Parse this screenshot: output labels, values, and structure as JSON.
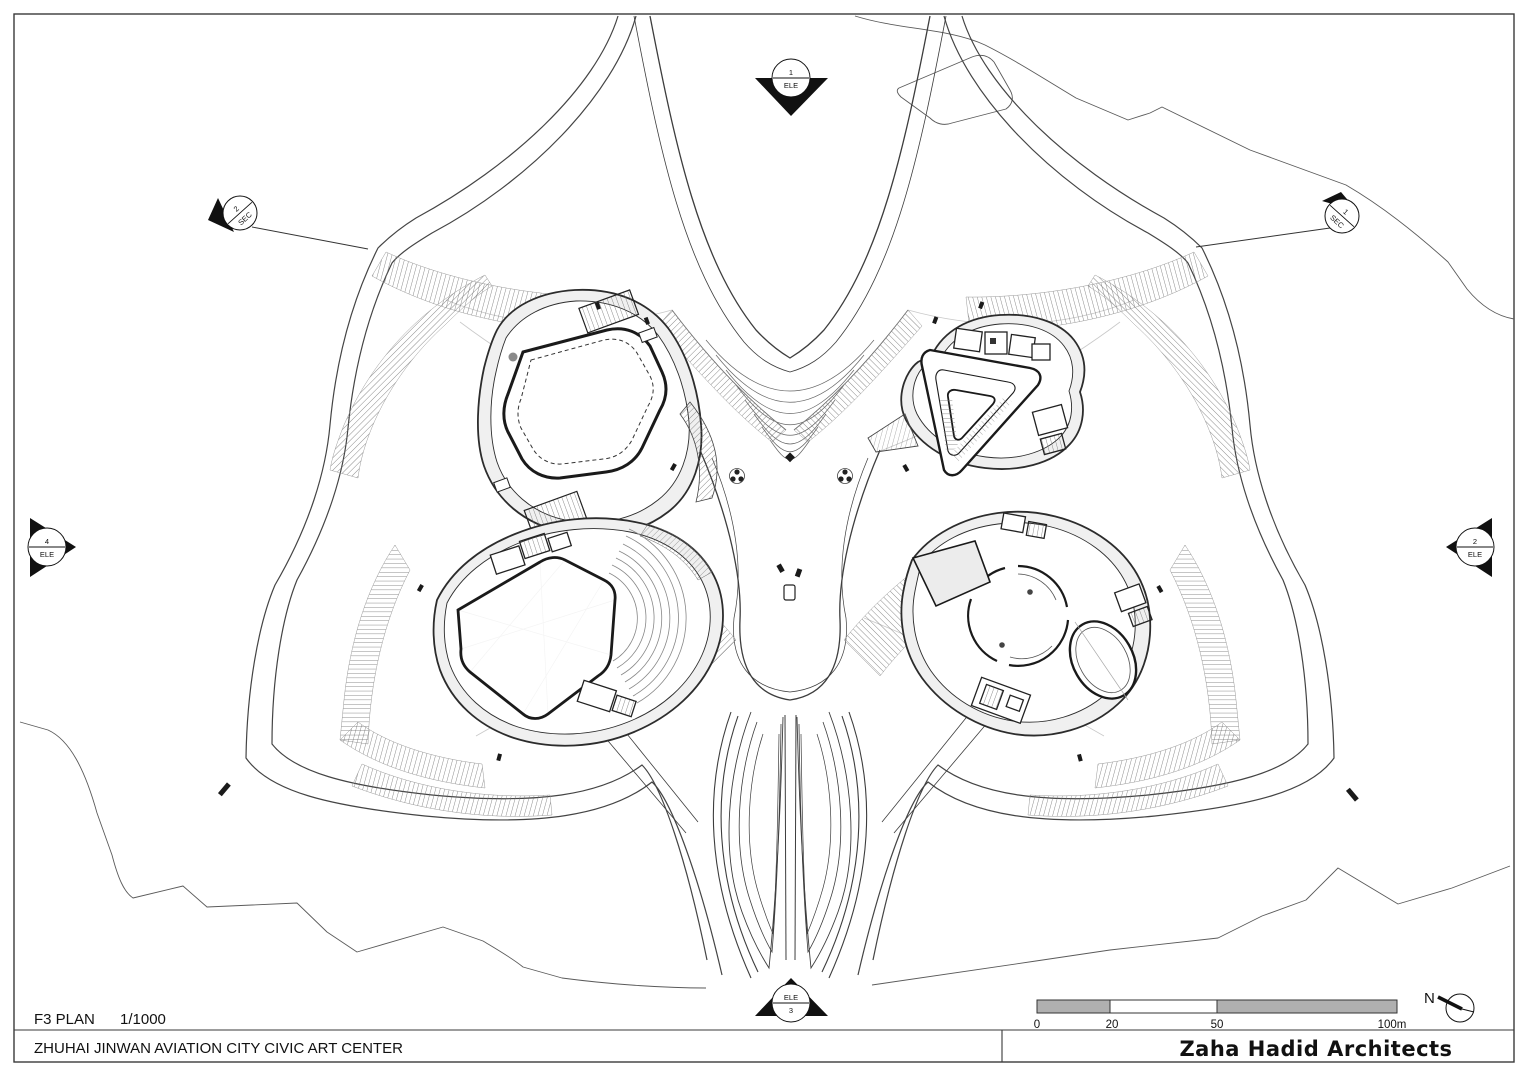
{
  "title_block": {
    "plan_label": "F3 PLAN",
    "scale": "1/1000",
    "project_name": "ZHUHAI JINWAN AVIATION CITY CIVIC ART CENTER",
    "firm_name": "Zaha Hadid Architects"
  },
  "scale_bar": {
    "labels": [
      "0",
      "20",
      "50",
      "100m"
    ]
  },
  "compass": {
    "label": "N"
  },
  "markers": {
    "elevation_top": {
      "top": "1",
      "bottom": "ELE"
    },
    "section_left": {
      "top": "2",
      "bottom": "SEC"
    },
    "section_right": {
      "top": "1",
      "bottom": "SEC"
    },
    "elevation_left": {
      "top": "4",
      "bottom": "ELE"
    },
    "elevation_right": {
      "top": "2",
      "bottom": "ELE"
    },
    "elevation_bottom": {
      "top": "ELE",
      "bottom": "3"
    }
  },
  "colors": {
    "line": "#1a1a1a",
    "medium_line": "#555555",
    "light_line": "#c9c9c9",
    "hatch": "#777777",
    "walkway_fill": "#f0f0f0",
    "scale_bar_fill": "#b0b0b0",
    "paper": "#ffffff"
  }
}
